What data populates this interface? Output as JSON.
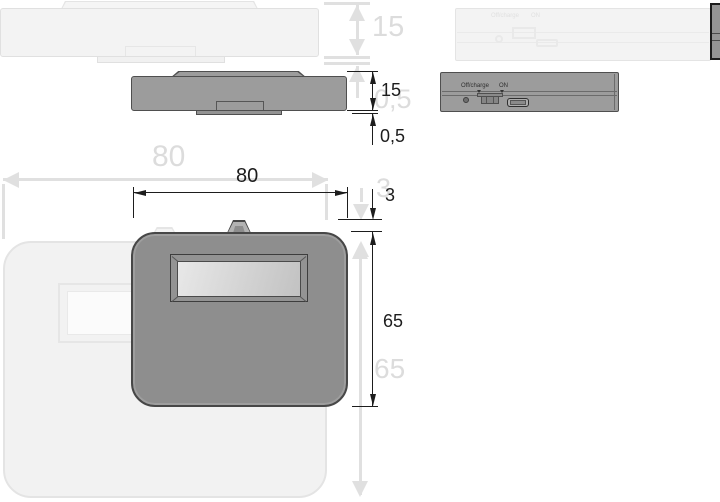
{
  "drawing": {
    "dimensions": {
      "height_mm": "15",
      "base_offset_mm": "0,5",
      "width_mm": "80",
      "clip_height_mm": "3",
      "depth_mm": "65"
    },
    "rear_panel": {
      "switch_label_off": "Off/charge",
      "switch_label_on": "ON"
    },
    "colors": {
      "ink": "#1d1d1d",
      "ghost_line": "#e0e0e0",
      "ghost_fill": "#f3f3f3",
      "body_fill": "#9c9c9c",
      "body_outline": "#4f4f4f"
    }
  }
}
